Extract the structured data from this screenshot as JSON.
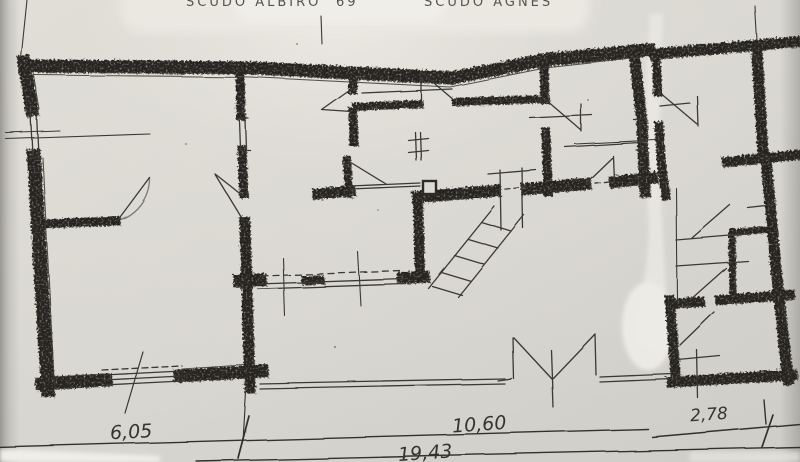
{
  "title": {
    "left": "SCUDO ALBIRO",
    "number": "69",
    "right": "SCUDO AGNES"
  },
  "dimensions": {
    "left": "6,05",
    "middle": "10,60",
    "right": "2,78",
    "total": "19,43"
  },
  "colors": {
    "paper": "#d8d6d0",
    "wall_crayon": "#2d2b27",
    "pen_ink": "#3b3934",
    "tear_highlight": "#ece9e2"
  },
  "drawing": {
    "type": "hand-drawn floor plan (scanned paper)",
    "features": [
      "main-building-outline",
      "top-left-room",
      "bottom-left-room",
      "central-bathroom",
      "top-right-rooms",
      "courtyard",
      "double-gate",
      "external-stair",
      "right-strip-annex",
      "window-symbols",
      "door-swings",
      "dimension-lines",
      "paper-tear"
    ]
  }
}
